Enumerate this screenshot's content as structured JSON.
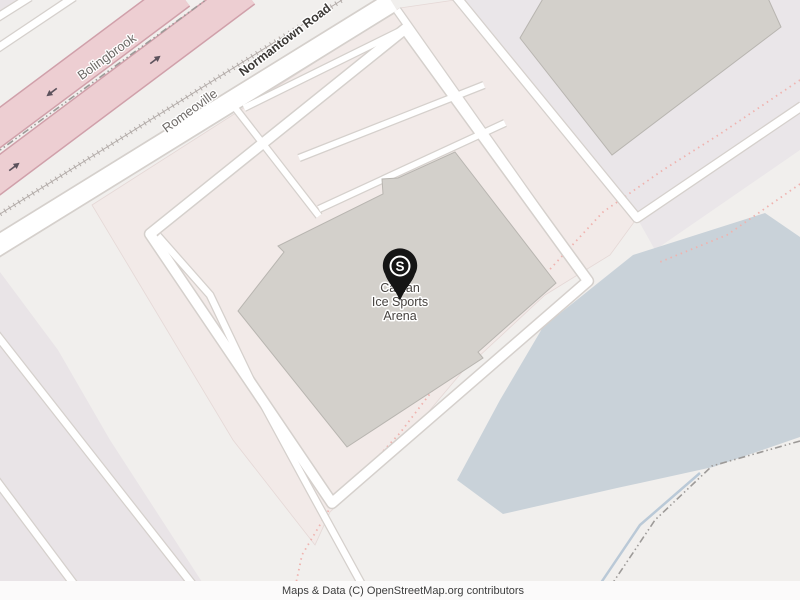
{
  "map": {
    "place_labels": {
      "bolingbrook": "Bolingbrook",
      "romeoville": "Romeoville"
    },
    "road_labels": {
      "main_road": "Normantown Road"
    },
    "poi": {
      "name": "Canlan Ice Sports Arena",
      "name_lines": [
        "Canlan",
        "Ice Sports",
        "Arena"
      ],
      "marker_glyph": "S"
    },
    "attribution": "Maps & Data (C) OpenStreetMap.org contributors",
    "colors": {
      "background": "#f1efed",
      "parking_landuse": "#f2eae8",
      "block_landuse_purple": "#e9e4e7",
      "retail_landuse": "#eae6e9",
      "highway_fill": "#edced2",
      "highway_casing": "#d0a0aa",
      "road_fill": "#ffffff",
      "road_casing": "#d5d0cc",
      "building_fill": "#d3d0cb",
      "building_stroke": "#b8b5b0",
      "water": "#c9d2d9",
      "stream": "#bac9d7",
      "admin_boundary": "#9d9a98",
      "path_dotted": "#efb3af",
      "marker": "#151515",
      "label_dark": "#3c3936",
      "label_gray": "#6e6a67",
      "poi_label": "#474340"
    }
  }
}
